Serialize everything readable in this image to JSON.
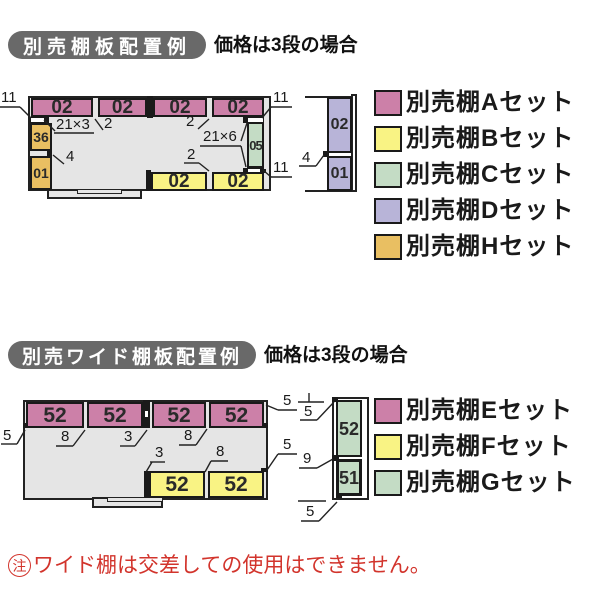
{
  "top_section": {
    "badge": "別売棚板配置例",
    "subtitle": "価格は3段の場合",
    "plan": {
      "pink_shelves": [
        "02",
        "02",
        "02",
        "02"
      ],
      "yellow_shelves": [
        "02",
        "02"
      ],
      "left_shelves": [
        "36",
        "01"
      ],
      "right_shelf": "05",
      "dims": {
        "tl_11": "11",
        "shelf_21x3": "21×3",
        "gap_2_left": "2",
        "gap_2_right": "2",
        "side_4": "4",
        "shelf_21x6": "21×6",
        "gap_2_bottom": "2",
        "tr_11": "11",
        "br_11": "11"
      }
    },
    "side_view": {
      "shelves": [
        "02",
        "01"
      ],
      "dim_4": "4"
    },
    "legend": [
      {
        "label": "別売棚Aセット",
        "color": "#cc80a8"
      },
      {
        "label": "別売棚Bセット",
        "color": "#f9f384"
      },
      {
        "label": "別売棚Cセット",
        "color": "#c4dcc5"
      },
      {
        "label": "別売棚Dセット",
        "color": "#b8b4d8"
      },
      {
        "label": "別売棚Hセット",
        "color": "#e9bf62"
      }
    ]
  },
  "bottom_section": {
    "badge": "別売ワイド棚板配置例",
    "subtitle": "価格は3段の場合",
    "plan": {
      "pink_shelves": [
        "52",
        "52",
        "52",
        "52"
      ],
      "yellow_shelves": [
        "52",
        "52"
      ],
      "dims": {
        "left_5": "5",
        "gap_8_a": "8",
        "gap_3_a": "3",
        "gap_8_b": "8",
        "gap_3_b": "3",
        "gap_8_c": "8",
        "top_right_5": "5",
        "right_5": "5"
      }
    },
    "side_view": {
      "shelves": [
        "52",
        "51"
      ],
      "dims": {
        "top_5": "5",
        "mid_9": "9",
        "bottom_5": "5"
      }
    },
    "legend": [
      {
        "label": "別売棚Eセット",
        "color": "#cc80a8"
      },
      {
        "label": "別売棚Fセット",
        "color": "#f9f384"
      },
      {
        "label": "別売棚Gセット",
        "color": "#c4dcc5"
      }
    ]
  },
  "note": {
    "mark": "注",
    "text": "ワイド棚は交差しての使用はできません。",
    "color": "#d2342c"
  },
  "colors": {
    "shelf_pink": "#cc80a8",
    "shelf_yellow": "#f9f384",
    "shelf_green": "#c4dcc5",
    "shelf_purple": "#b8b4d8",
    "shelf_orange": "#e9bf62",
    "floor_gray": "#e5e5e5",
    "badge_gray": "#696969",
    "note_red": "#d2342c"
  }
}
